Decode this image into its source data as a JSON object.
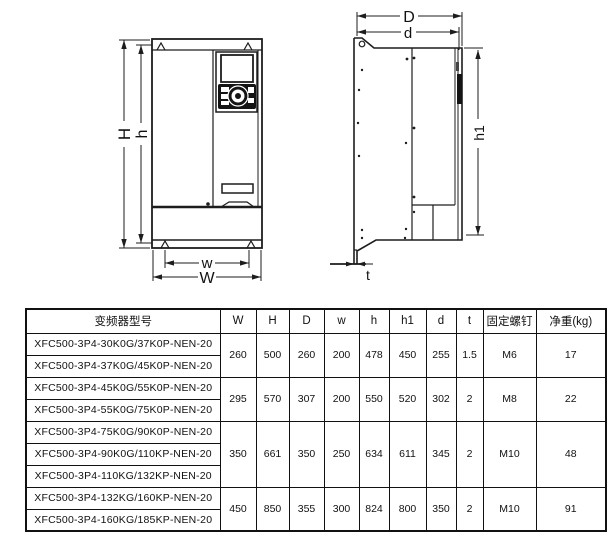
{
  "diagram": {
    "front_labels": {
      "H": "H",
      "h": "h",
      "w": "w",
      "W": "W"
    },
    "side_labels": {
      "D": "D",
      "d": "d",
      "h1": "h1",
      "t": "t"
    }
  },
  "table": {
    "headers": [
      "变频器型号",
      "W",
      "H",
      "D",
      "w",
      "h",
      "h1",
      "d",
      "t",
      "固定螺钉",
      "净重(kg)"
    ],
    "models": [
      "XFC500-3P4-30K0G/37K0P-NEN-20",
      "XFC500-3P4-37K0G/45K0P-NEN-20",
      "XFC500-3P4-45K0G/55K0P-NEN-20",
      "XFC500-3P4-55K0G/75K0P-NEN-20",
      "XFC500-3P4-75K0G/90K0P-NEN-20",
      "XFC500-3P4-90K0G/110KP-NEN-20",
      "XFC500-3P4-110KG/132KP-NEN-20",
      "XFC500-3P4-132KG/160KP-NEN-20",
      "XFC500-3P4-160KG/185KP-NEN-20"
    ],
    "groups": [
      {
        "W": "260",
        "H": "500",
        "D": "260",
        "w": "200",
        "h": "478",
        "h1": "450",
        "d": "255",
        "t": "1.5",
        "screw": "M6",
        "weight": "17"
      },
      {
        "W": "295",
        "H": "570",
        "D": "307",
        "w": "200",
        "h": "550",
        "h1": "520",
        "d": "302",
        "t": "2",
        "screw": "M8",
        "weight": "22"
      },
      {
        "W": "350",
        "H": "661",
        "D": "350",
        "w": "250",
        "h": "634",
        "h1": "611",
        "d": "345",
        "t": "2",
        "screw": "M10",
        "weight": "48"
      },
      {
        "W": "450",
        "H": "850",
        "D": "355",
        "w": "300",
        "h": "824",
        "h1": "800",
        "d": "350",
        "t": "2",
        "screw": "M10",
        "weight": "91"
      }
    ]
  }
}
